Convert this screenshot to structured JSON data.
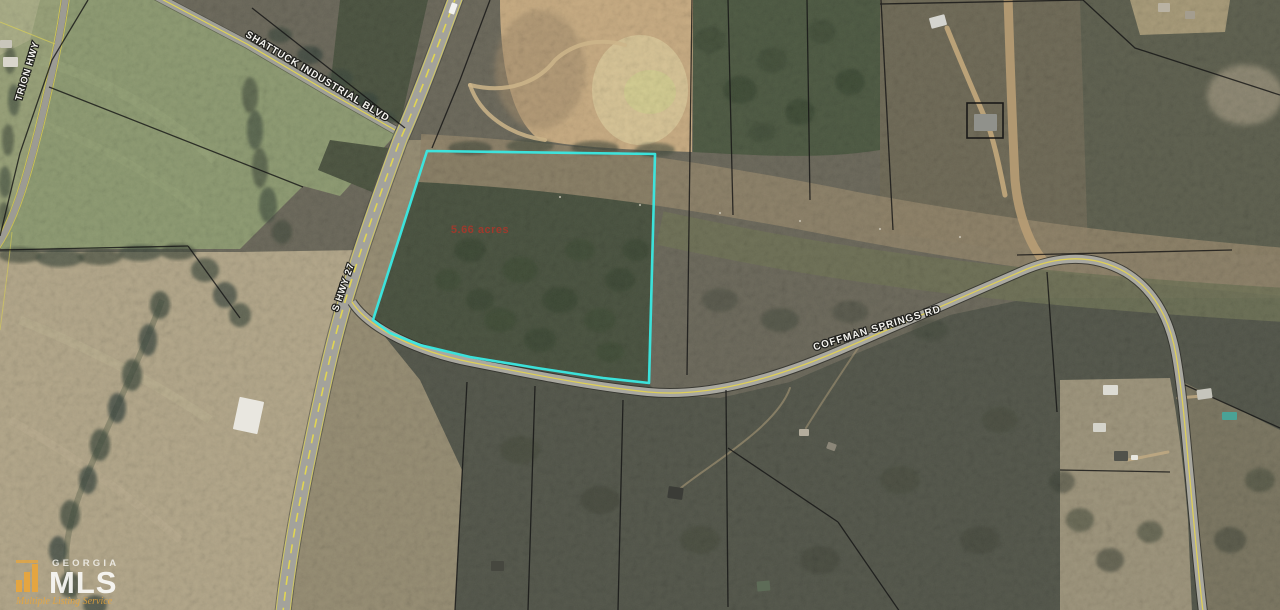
{
  "map": {
    "road_labels": {
      "shattuck": "SHATTUCK INDUSTRIAL BLVD",
      "trion": "TRION HWY",
      "s_hwy_27": "S HWY 27",
      "coffman_springs": "COFFMAN SPRINGS RD"
    },
    "parcel": {
      "acreage_label": "5.66 acres",
      "outline_color": "#3AE9E3",
      "acreage_text_color": "#B23428"
    },
    "watermark": {
      "brand_region": "GEORGIA",
      "brand_name": "MLS",
      "tagline": "Multiple Listing Service",
      "accent_color": "#E9A63C"
    }
  }
}
